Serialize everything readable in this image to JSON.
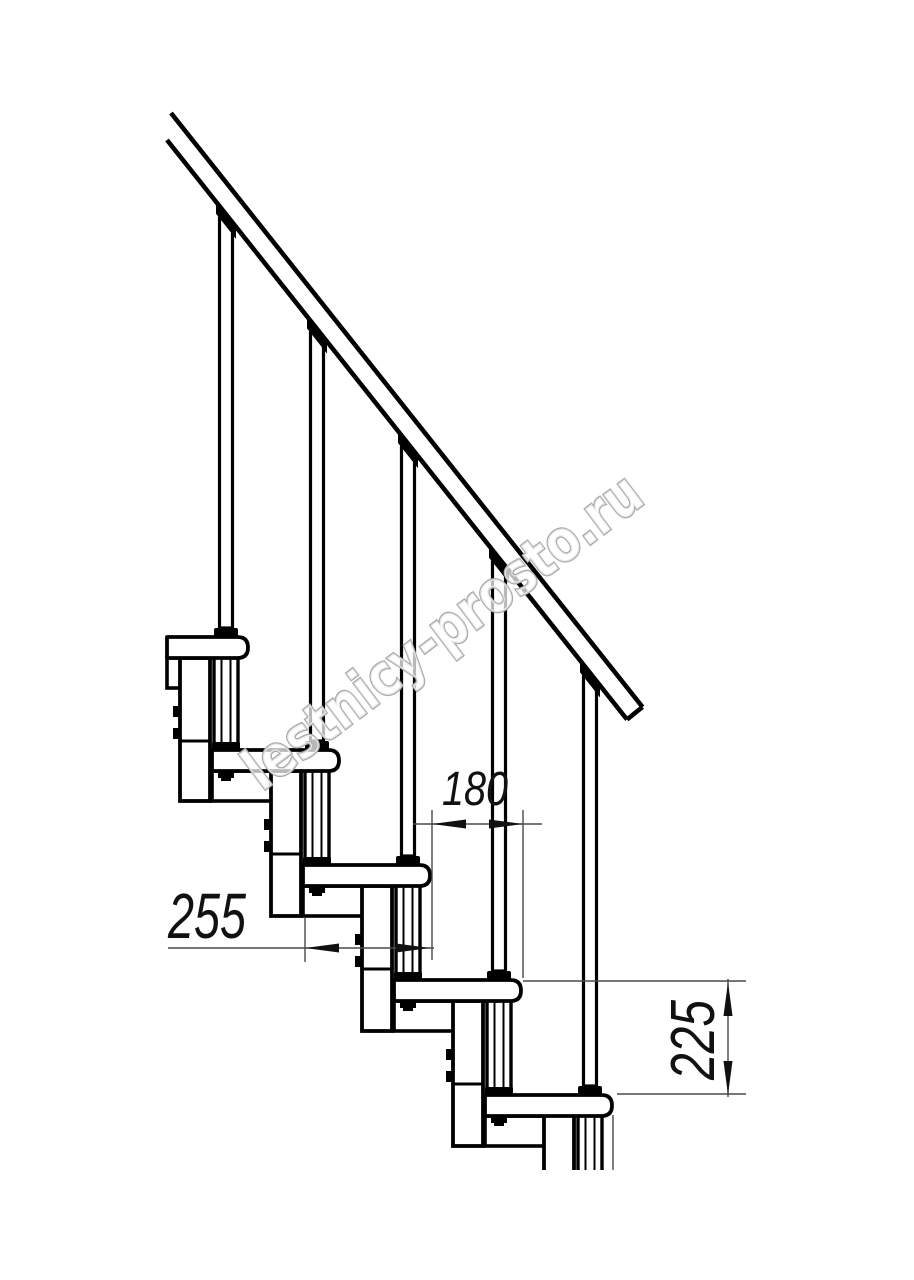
{
  "dimensions": {
    "step_run": "180",
    "tread_depth": "255",
    "step_rise": "225"
  },
  "watermark": {
    "text": "lestnicy-prosto.ru"
  },
  "colors": {
    "line": "#000000",
    "dim_line": "#4a4a4a",
    "watermark": "#aaaaaa"
  }
}
